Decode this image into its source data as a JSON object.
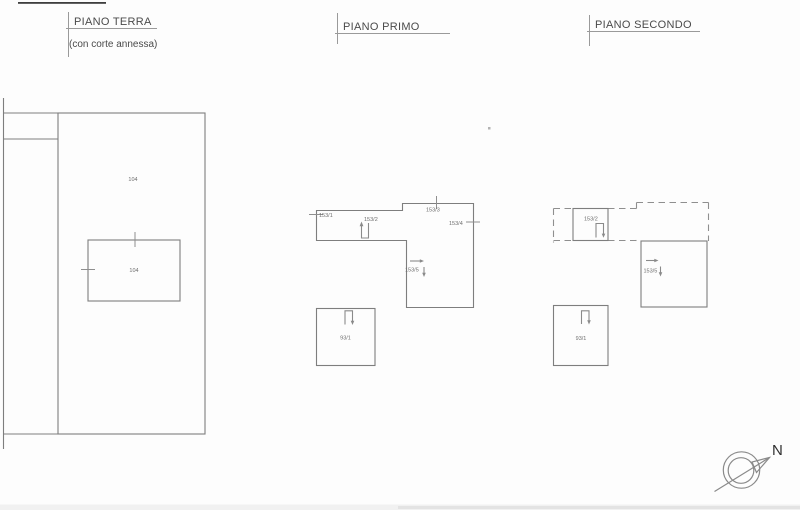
{
  "palette": {
    "background": "#fdfdfd",
    "wall_line": "#8f8f8f",
    "scan_edge_dark": "#3f3f3f",
    "title_text": "#4a4a4a",
    "label_text": "#6e6e6e"
  },
  "plans": {
    "terra": {
      "title": "PIANO TERRA",
      "subtitle": "(con corte annessa)",
      "outer_parcel_label": "104",
      "inner_parcel_label": "104"
    },
    "primo": {
      "title": "PIANO PRIMO",
      "tick_left_label": "153/1",
      "stair_label": "153/2",
      "tick_top_label": "153/3",
      "tick_right_label": "153/4",
      "room_label": "153/5",
      "annex_label": "93/1"
    },
    "secondo": {
      "title": "PIANO SECONDO",
      "stair_label": "153/2",
      "room_label": "153/5",
      "annex_label": "93/1"
    }
  },
  "compass": {
    "north_label": "N"
  }
}
